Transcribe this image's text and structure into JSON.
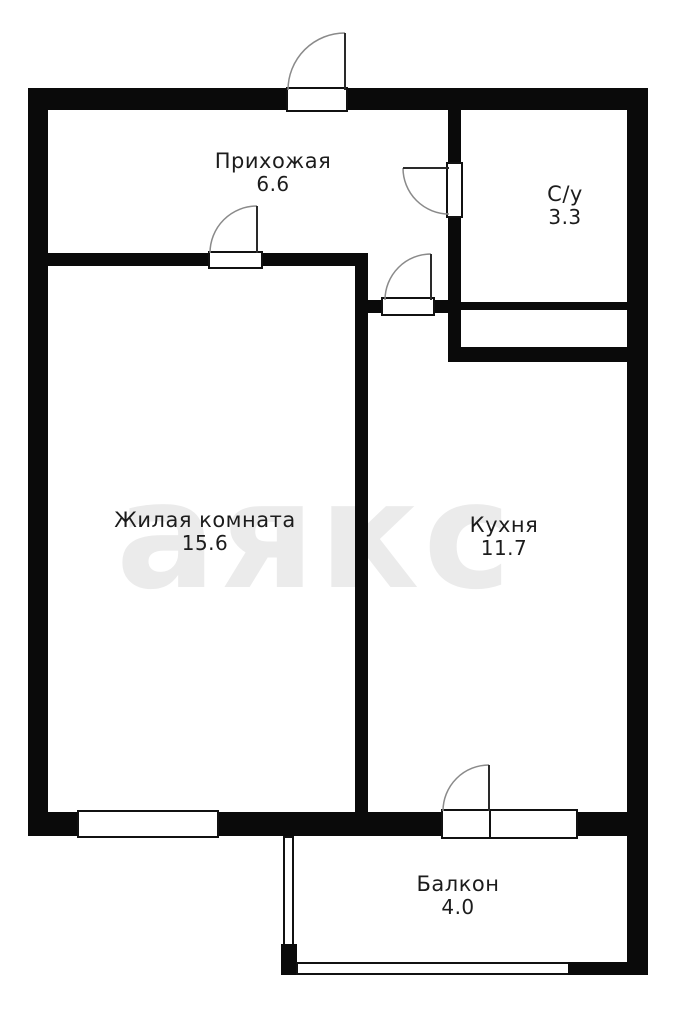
{
  "watermark": "аякс",
  "rooms": [
    {
      "name": "Прихожая",
      "area": "6.6"
    },
    {
      "name": "С/у",
      "area": "3.3"
    },
    {
      "name": "Жилая комната",
      "area": "15.6"
    },
    {
      "name": "Кухня",
      "area": "11.7"
    },
    {
      "name": "Балкон",
      "area": "4.0"
    }
  ],
  "colors": {
    "wall": "#0a0a0a",
    "background": "#ffffff",
    "door_arc": "#8a8a8a",
    "door_leaf": "#2a2a2a",
    "watermark": "#ebebeb",
    "label_text": "#1c1c1c"
  }
}
